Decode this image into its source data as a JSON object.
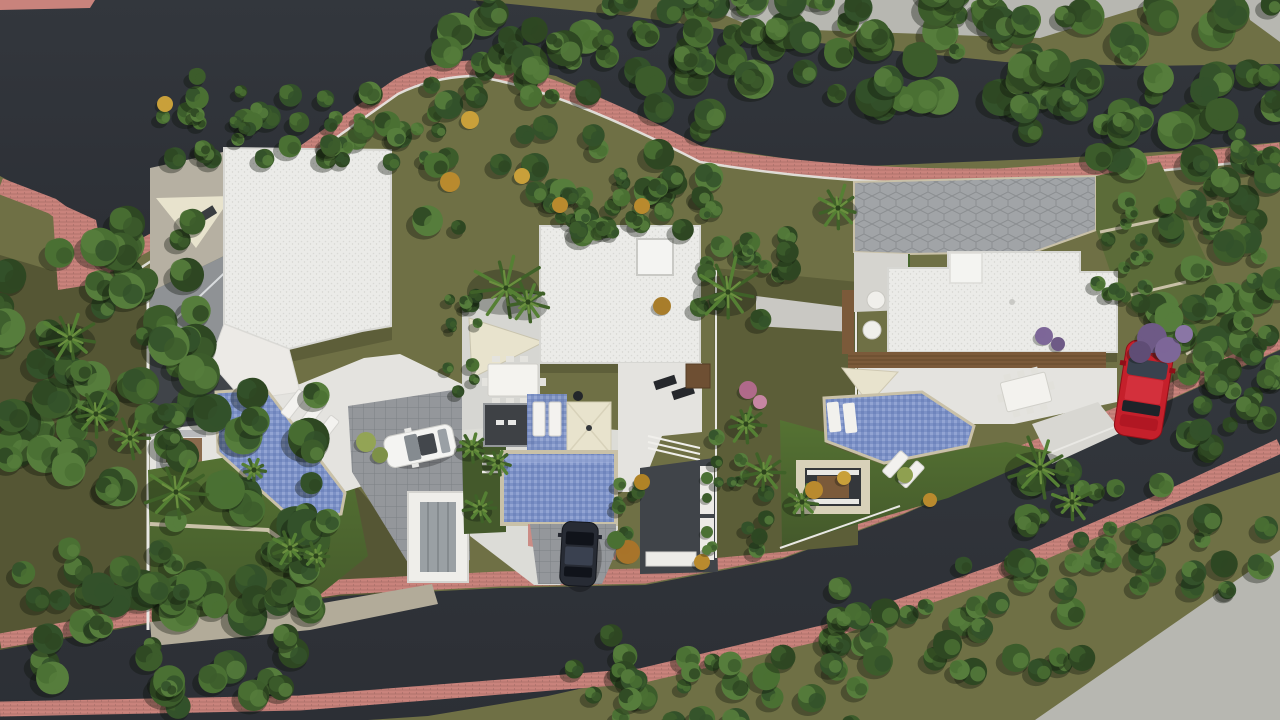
{
  "scene": {
    "title": "aerial-top-view-render-three-villas",
    "description": "Photorealistic bird's-eye architectural render of a hillside plot with three modern flat-roof villas, private pools, gardens, curved asphalt roads with pink paved sidewalks and dense tree lines"
  },
  "palette": {
    "road": "#2c2f35",
    "road_hi": "#33373d",
    "sidewalk": "#c9837c",
    "verge": "#6f7045",
    "verge_dark": "#5c5e38",
    "lawn": "#557233",
    "lawn_dark": "#44592b",
    "concrete": "#b7b7b1",
    "roof": "#ebebe8",
    "roof_line": "#d7d7d3",
    "terrace": "#e4e3df",
    "tile": "#d6d6d2",
    "paver": "#94979b",
    "stone": "#c9c1a8",
    "pool": "#7c91c6",
    "pool_light": "#a4b4dd",
    "pool_deep": "#6279b4",
    "deck": "#7b5a3a",
    "deck_line": "#5f4429",
    "sail": "#e8e3cd",
    "patio_dark": "#404449",
    "wall": "#e9e8e4",
    "car_white": "#f4f4f2",
    "car_dark": "#272b34",
    "car_red": "#c5202b"
  },
  "objects": {
    "villas": [
      {
        "label": "west-villa-white-flat-roof"
      },
      {
        "label": "middle-villa-white-flat-roof-with-skylight"
      },
      {
        "label": "east-villa-white-flat-roof-with-wood-deck"
      }
    ],
    "pools": [
      {
        "label": "west-diagonal-pool"
      },
      {
        "label": "middle-rectangular-pool"
      },
      {
        "label": "east-angular-pool"
      }
    ],
    "cars": [
      {
        "label": "white-hatchback-on-west-driveway",
        "transform": "translate(420,446) rotate(-12)"
      },
      {
        "label": "dark-sedan-on-middle-driveway",
        "transform": "translate(579,554) rotate(3)"
      },
      {
        "label": "red-suv-on-east-road",
        "transform": "translate(1144,390) rotate(9)"
      }
    ]
  },
  "vegetation": {
    "shadow": "#0b100a",
    "tree_colors": [
      "#2e4722",
      "#3c5c2b",
      "#4a7033",
      "#567d3c",
      "#33512a"
    ],
    "palm_colors": [
      "#3f6128",
      "#558034",
      "#6b8f3f"
    ],
    "tree_clusters": [
      {
        "x": 430,
        "y": -12,
        "w": 330,
        "h": 100,
        "n": 46,
        "r0": 8,
        "r1": 19,
        "s": 1
      },
      {
        "x": 730,
        "y": -12,
        "w": 320,
        "h": 125,
        "n": 48,
        "r0": 8,
        "r1": 20,
        "s": 2
      },
      {
        "x": 1020,
        "y": 5,
        "w": 260,
        "h": 165,
        "n": 46,
        "r0": 9,
        "r1": 21,
        "s": 3
      },
      {
        "x": 1155,
        "y": 150,
        "w": 125,
        "h": 235,
        "n": 40,
        "r0": 8,
        "r1": 18,
        "s": 4
      },
      {
        "x": 1185,
        "y": 335,
        "w": 95,
        "h": 125,
        "n": 20,
        "r0": 7,
        "r1": 14,
        "s": 5
      },
      {
        "x": 0,
        "y": 210,
        "w": 200,
        "h": 270,
        "n": 48,
        "r0": 9,
        "r1": 21,
        "s": 6
      },
      {
        "x": 60,
        "y": 370,
        "w": 270,
        "h": 250,
        "n": 46,
        "r0": 9,
        "r1": 21,
        "s": 7
      },
      {
        "x": 0,
        "y": 545,
        "w": 310,
        "h": 165,
        "n": 38,
        "r0": 8,
        "r1": 18,
        "s": 8
      },
      {
        "x": 555,
        "y": 635,
        "w": 310,
        "h": 90,
        "n": 30,
        "r0": 7,
        "r1": 15,
        "s": 9
      },
      {
        "x": 815,
        "y": 560,
        "w": 270,
        "h": 120,
        "n": 34,
        "r0": 7,
        "r1": 15,
        "s": 10
      },
      {
        "x": 1025,
        "y": 468,
        "w": 245,
        "h": 125,
        "n": 34,
        "r0": 7,
        "r1": 15,
        "s": 11
      },
      {
        "x": 150,
        "y": 70,
        "w": 290,
        "h": 95,
        "n": 26,
        "r0": 6,
        "r1": 13,
        "s": 12
      },
      {
        "x": 425,
        "y": 92,
        "w": 300,
        "h": 140,
        "n": 38,
        "r0": 7,
        "r1": 16,
        "s": 13
      },
      {
        "x": 535,
        "y": 182,
        "w": 185,
        "h": 55,
        "n": 20,
        "r0": 6,
        "r1": 12,
        "s": 14
      },
      {
        "x": 698,
        "y": 200,
        "w": 95,
        "h": 125,
        "n": 18,
        "r0": 6,
        "r1": 12,
        "s": 15
      },
      {
        "x": 225,
        "y": 118,
        "w": 195,
        "h": 48,
        "n": 18,
        "r0": 6,
        "r1": 11,
        "s": 16
      },
      {
        "x": 448,
        "y": 285,
        "w": 30,
        "h": 120,
        "n": 12,
        "r0": 4,
        "r1": 8,
        "s": 17
      },
      {
        "x": 712,
        "y": 415,
        "w": 60,
        "h": 135,
        "n": 14,
        "r0": 5,
        "r1": 9,
        "s": 18
      },
      {
        "x": 1096,
        "y": 190,
        "w": 75,
        "h": 115,
        "n": 16,
        "r0": 5,
        "r1": 10,
        "s": 19
      },
      {
        "x": 615,
        "y": 480,
        "w": 40,
        "h": 60,
        "n": 8,
        "r0": 4,
        "r1": 8,
        "s": 20
      }
    ],
    "palms": [
      {
        "x": 70,
        "y": 338,
        "r": 30
      },
      {
        "x": 176,
        "y": 492,
        "r": 34
      },
      {
        "x": 290,
        "y": 548,
        "r": 18
      },
      {
        "x": 316,
        "y": 556,
        "r": 14
      },
      {
        "x": 506,
        "y": 288,
        "r": 38
      },
      {
        "x": 528,
        "y": 302,
        "r": 24
      },
      {
        "x": 728,
        "y": 292,
        "r": 34
      },
      {
        "x": 746,
        "y": 424,
        "r": 20
      },
      {
        "x": 764,
        "y": 472,
        "r": 20
      },
      {
        "x": 802,
        "y": 502,
        "r": 18
      },
      {
        "x": 838,
        "y": 208,
        "r": 24
      },
      {
        "x": 1040,
        "y": 468,
        "r": 34
      },
      {
        "x": 1072,
        "y": 502,
        "r": 20
      },
      {
        "x": 472,
        "y": 448,
        "r": 16
      },
      {
        "x": 498,
        "y": 462,
        "r": 14
      },
      {
        "x": 480,
        "y": 508,
        "r": 16
      },
      {
        "x": 96,
        "y": 414,
        "r": 24
      },
      {
        "x": 130,
        "y": 438,
        "r": 20
      },
      {
        "x": 254,
        "y": 470,
        "r": 13
      }
    ],
    "shrubs": [
      {
        "x": 450,
        "y": 182,
        "r": 10,
        "c": "#b98a2e"
      },
      {
        "x": 522,
        "y": 176,
        "r": 8,
        "c": "#c9a03a"
      },
      {
        "x": 642,
        "y": 206,
        "r": 8,
        "c": "#b98a2e"
      },
      {
        "x": 165,
        "y": 104,
        "r": 8,
        "c": "#c9a03a"
      },
      {
        "x": 662,
        "y": 306,
        "r": 9,
        "c": "#a87d2b"
      },
      {
        "x": 814,
        "y": 490,
        "r": 9,
        "c": "#b98a2e"
      },
      {
        "x": 844,
        "y": 478,
        "r": 7,
        "c": "#c9a03a"
      },
      {
        "x": 702,
        "y": 562,
        "r": 8,
        "c": "#b98a2e"
      },
      {
        "x": 642,
        "y": 482,
        "r": 8,
        "c": "#b08326"
      },
      {
        "x": 628,
        "y": 552,
        "r": 12,
        "c": "#a8742a"
      },
      {
        "x": 616,
        "y": 540,
        "r": 9,
        "c": "#4a7033"
      },
      {
        "x": 748,
        "y": 390,
        "r": 9,
        "c": "#b06a8a"
      },
      {
        "x": 760,
        "y": 402,
        "r": 7,
        "c": "#c786a3"
      },
      {
        "x": 1152,
        "y": 338,
        "r": 15,
        "c": "#6e5a86"
      },
      {
        "x": 1168,
        "y": 350,
        "r": 13,
        "c": "#7d6798"
      },
      {
        "x": 1140,
        "y": 352,
        "r": 11,
        "c": "#5f4d75"
      },
      {
        "x": 1184,
        "y": 334,
        "r": 9,
        "c": "#8a76a5"
      },
      {
        "x": 1044,
        "y": 336,
        "r": 9,
        "c": "#7d6798"
      },
      {
        "x": 1058,
        "y": 344,
        "r": 7,
        "c": "#6e5a86"
      },
      {
        "x": 366,
        "y": 442,
        "r": 10,
        "c": "#93a455"
      },
      {
        "x": 380,
        "y": 455,
        "r": 8,
        "c": "#7e9148"
      },
      {
        "x": 470,
        "y": 120,
        "r": 9,
        "c": "#c9a03a"
      },
      {
        "x": 560,
        "y": 205,
        "r": 8,
        "c": "#b98a2e"
      },
      {
        "x": 905,
        "y": 475,
        "r": 8,
        "c": "#8fa050"
      },
      {
        "x": 930,
        "y": 500,
        "r": 7,
        "c": "#b98a2e"
      },
      {
        "x": 707,
        "y": 478,
        "r": 6,
        "c": "#4a7033"
      },
      {
        "x": 707,
        "y": 498,
        "r": 5,
        "c": "#3c5c2b"
      },
      {
        "x": 707,
        "y": 532,
        "r": 6,
        "c": "#4a7033"
      },
      {
        "x": 707,
        "y": 550,
        "r": 5,
        "c": "#567d3c"
      }
    ]
  }
}
